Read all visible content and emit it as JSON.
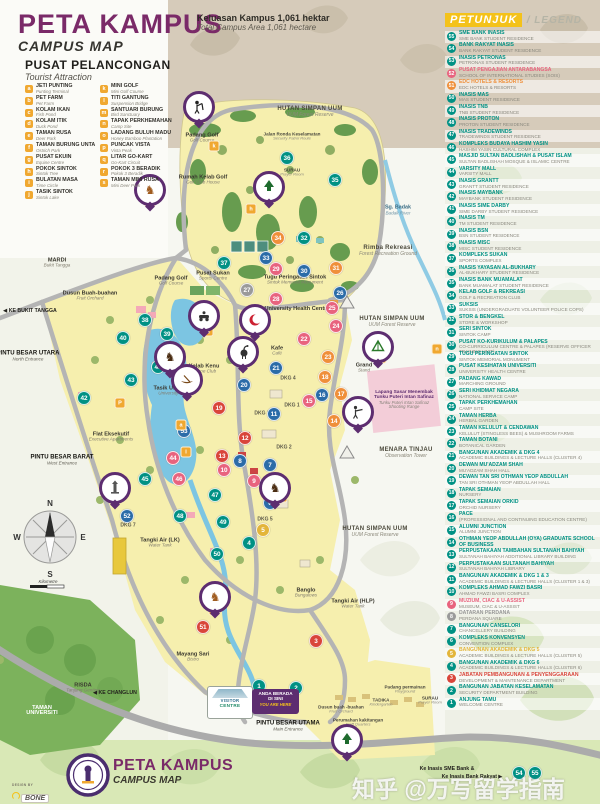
{
  "header": {
    "title": "PETA KAMPUS",
    "subtitle": "CAMPUS MAP",
    "area_my": "Keluasan Kampus 1,061 hektar",
    "area_en": "Total Campus Area 1,061 hectare"
  },
  "tourist": {
    "title": "PUSAT PELANCONGAN",
    "subtitle": "Tourist Attraction",
    "items": [
      {
        "letter": "a",
        "name": "JETI PUNTING",
        "en": "Punting Terminal"
      },
      {
        "letter": "b",
        "name": "PET FARM",
        "en": "Pet Farm"
      },
      {
        "letter": "c",
        "name": "KOLAM IKAN",
        "en": "Fish Pond"
      },
      {
        "letter": "d",
        "name": "KOLAM ITIK",
        "en": "Duck Pond"
      },
      {
        "letter": "e",
        "name": "TAMAN RUSA",
        "en": "Deer Park"
      },
      {
        "letter": "f",
        "name": "TAMAN BURUNG UNTA",
        "en": "Ostrich Park"
      },
      {
        "letter": "g",
        "name": "PUSAT EKUIN",
        "en": "Equine Centre"
      },
      {
        "letter": "h",
        "name": "POKOK SINTOK",
        "en": "Sintok Tree"
      },
      {
        "letter": "i",
        "name": "BULATAN MASA",
        "en": "Time Circle"
      },
      {
        "letter": "j",
        "name": "TASIK SINTOK",
        "en": "Sintok Lake"
      },
      {
        "letter": "k",
        "name": "MINI GOLF",
        "en": "Mini Golf Course"
      },
      {
        "letter": "l",
        "name": "TITI GANTUNG",
        "en": "Suspension Bridge"
      },
      {
        "letter": "m",
        "name": "SANTUARI BURUNG",
        "en": "Bird Sanctuary"
      },
      {
        "letter": "n",
        "name": "TAPAK PERKHEMAHAN",
        "en": "Camp Site"
      },
      {
        "letter": "o",
        "name": "LADANG BULUH MADU",
        "en": "Honey Bamboo Plantation"
      },
      {
        "letter": "p",
        "name": "PUNCAK VISTA",
        "en": "Vista Peak"
      },
      {
        "letter": "q",
        "name": "LITAR GO-KART",
        "en": "Go-Kart Circuit"
      },
      {
        "letter": "r",
        "name": "POKOK 3 BERADIK",
        "en": "Pokok 3 Beradik"
      },
      {
        "letter": "s",
        "name": "TAMAN MINI RUSA",
        "en": "Mini Deer Park"
      }
    ]
  },
  "legend": {
    "title": "PETUNJUK",
    "title_en": "/  LEGEND",
    "items": [
      {
        "n": 55,
        "my": "SME BANK INASIS",
        "en": "SME BANK STUDENT RESIDENCE"
      },
      {
        "n": 54,
        "my": "BANK RAKYAT INASIS",
        "en": "BANK RAKYAT STUDENT RESIDENCE"
      },
      {
        "n": 53,
        "my": "INASIS PETRONAS",
        "en": "PETRONAS STUDENT RESIDENCE"
      },
      {
        "n": 52,
        "my": "PUSAT PENGAJIAN ANTARABANGSA",
        "en": "SCHOOL OF INTERNATIONAL STUDIES (SOIS)",
        "c": "#e8637e"
      },
      {
        "n": 51,
        "my": "EDC HOTELS & RESORTS",
        "en": "EDC HOTELS & RESORTS",
        "c": "#ef8f3a"
      },
      {
        "n": 50,
        "my": "INASIS MAS",
        "en": "MAS STUDENT RESIDENCE"
      },
      {
        "n": 49,
        "my": "INASIS TNB",
        "en": "TNB STUDENT RESIDENCE"
      },
      {
        "n": 48,
        "my": "INASIS PROTON",
        "en": "PROTON STUDENT RESIDENCE"
      },
      {
        "n": 47,
        "my": "INASIS TRADEWINDS",
        "en": "TRADEWINDS STUDENT RESIDENCE"
      },
      {
        "n": 46,
        "my": "KOMPLEKS BUDAYA HASHIM YASIN",
        "en": "HASHIM YASIN CULTURAL COMPLEX"
      },
      {
        "n": 45,
        "my": "MASJID SULTAN BADLISHAH & PUSAT ISLAM",
        "en": "SULTAN BADLISHAH MOSQUE & ISLAMIC CENTRE"
      },
      {
        "n": 44,
        "my": "VARSITY MALL",
        "en": "VARSITY MALL"
      },
      {
        "n": 43,
        "my": "INASIS GRANTT",
        "en": "GRANTT STUDENT RESIDENCE"
      },
      {
        "n": 42,
        "my": "INASIS MAYBANK",
        "en": "MAYBANK STUDENT RESIDENCE"
      },
      {
        "n": 41,
        "my": "INASIS SIME DARBY",
        "en": "SIME DARBY STUDENT RESIDENCE"
      },
      {
        "n": 40,
        "my": "INASIS TM",
        "en": "TM STUDENT RESIDENCE"
      },
      {
        "n": 39,
        "my": "INASIS BSN",
        "en": "BSN STUDENT RESIDENCE"
      },
      {
        "n": 38,
        "my": "INASIS MISC",
        "en": "MISC STUDENT RESIDENCE"
      },
      {
        "n": 37,
        "my": "KOMPLEKS SUKAN",
        "en": "SPORTS COMPLEX"
      },
      {
        "n": 36,
        "my": "INASIS YAYASAN AL-BUKHARY",
        "en": "AL-BUKHARY STUDENT RESIDENCE"
      },
      {
        "n": 35,
        "my": "INASIS BANK MUAMALAT",
        "en": "BANK MUAMALAT STUDENT RESIDENCE"
      },
      {
        "n": 34,
        "my": "KELAB GOLF & REKREASI",
        "en": "GOLF & RECREATION CLUB"
      },
      {
        "n": 33,
        "my": "SUKSIS",
        "en": "SUKSIS (UNDERGRADUATE VOLUNTEER POLICE COPS)"
      },
      {
        "n": 32,
        "my": "STOR & BENGKEL",
        "en": "STORE & WORKSHOP"
      },
      {
        "n": 31,
        "my": "SERI SINTOK",
        "en": "SINTOK CAMP"
      },
      {
        "n": 30,
        "my": "PUSAT KO-KURIKULUM & PALAPES",
        "en": "CO-CURRICULUM CENTRE & PALAPES (RESERVE OFFICER TRAINING UNIT)"
      },
      {
        "n": 29,
        "my": "TUGU PERINGATAN SINTOK",
        "en": "SINTOK MEMORIAL MONUMENT"
      },
      {
        "n": 28,
        "my": "PUSAT KESIHATAN UNIVERSITI",
        "en": "UNIVERSITY HEALTH CENTRE"
      },
      {
        "n": 27,
        "my": "PADANG KAWAD",
        "en": "MARCHING GROUND"
      },
      {
        "n": 26,
        "my": "SERI KHIDMAT NEGARA",
        "en": "NATIONAL SERVICE CAMP"
      },
      {
        "n": 25,
        "my": "TAPAK PERKHEMAHAN",
        "en": "CAMP SITE"
      },
      {
        "n": 24,
        "my": "TAMAN HERBA",
        "en": "HERBAL GARDEN"
      },
      {
        "n": 23,
        "my": "TAMAN KELULUT & CENDAWAN",
        "en": "KELULUT (STINGLESS BEES) & MUSHROOM FARMS"
      },
      {
        "n": 22,
        "my": "TAMAN BOTANI",
        "en": "BOTANICAL GARDEN"
      },
      {
        "n": 21,
        "my": "BANGUNAN AKADEMIK & DKG 4",
        "en": "ACADEMIC BUILDINGS & LECTURE HALLS (CLUSTER 4)"
      },
      {
        "n": 20,
        "my": "DEWAN MU'ADZAM SHAH",
        "en": "MU'ADZAM SHAH HALL"
      },
      {
        "n": 19,
        "my": "DEWAN TAN SRI OTHMAN YEOP ABDULLAH",
        "en": "TAN SRI OTHMAN YEOP ABDULLAH HALL"
      },
      {
        "n": 18,
        "my": "TAPAK SEMAIAN",
        "en": "NURSERY"
      },
      {
        "n": 17,
        "my": "TAPAK SEMAIAN ORKID",
        "en": "ORCHID NURSERY"
      },
      {
        "n": 16,
        "my": "PACE",
        "en": "(PROFESSIONAL AND CONTINUING EDUCATION CENTRE)"
      },
      {
        "n": 15,
        "my": "ALUMNI JUNCTION",
        "en": "ALUMNI JUNCTION"
      },
      {
        "n": 14,
        "my": "OTHMAN YEOP ABDULLAH (OYA) GRADUATE SCHOOL OF BUSINESS",
        "en": ""
      },
      {
        "n": 13,
        "my": "PERPUSTAKAAN TAMBAHAN SULTANAH BAHIYAH",
        "en": "SULTANAH BAHIYAH ADDITIONAL LIBRARY BUILDING"
      },
      {
        "n": 12,
        "my": "PERPUSTAKAAN SULTANAH BAHIYAH",
        "en": "SULTANAH BAHIYAH LIBRARY"
      },
      {
        "n": 11,
        "my": "BANGUNAN AKADEMIK & DKG 1 & 3",
        "en": "ACADEMIC BUILDINGS & LECTURE HALLS (CLUSTER 1 & 3)"
      },
      {
        "n": 10,
        "my": "KOMPLEKS AHMAD FAWZI BASRI",
        "en": "AHMAD FAWZI BASRI COMPLEX"
      },
      {
        "n": 9,
        "my": "MUZIUM, CIAC & U-ASSIST",
        "en": "MUSEUM, CIAC & U-ASSIST",
        "c": "#e8637e"
      },
      {
        "n": 8,
        "my": "DATARAN PERDANA",
        "en": "PERDANA SQUARE",
        "c": "#9a9a9a"
      },
      {
        "n": 7,
        "my": "BANGUNAN CANSELORI",
        "en": "CHANCELLERY BUILDING"
      },
      {
        "n": 6,
        "my": "KOMPLEKS KONVENSYEN",
        "en": "CONVENTION COMPLEX"
      },
      {
        "n": 5,
        "my": "BANGUNAN AKADEMIK & DKG 5",
        "en": "ACADEMIC BUILDINGS & LECTURE HALLS (CLUSTER 5)",
        "c": "#e3b53a"
      },
      {
        "n": 4,
        "my": "BANGUNAN AKADEMIK & DKG 6",
        "en": "ACADEMIC BUILDINGS & LECTURE HALLS (CLUSTER 6)"
      },
      {
        "n": 3,
        "my": "JABATAN PEMBANGUNAN & PENYENGGARAAN",
        "en": "DEVELOPMENT & MAINTENANCE DEPARTMENT",
        "c": "#d9453a"
      },
      {
        "n": 2,
        "my": "BANGUNAN JABATAN KESELAMATAN",
        "en": "SECURITY DEPARTMENT BUILDING"
      },
      {
        "n": 1,
        "my": "ANJUNG TAMU",
        "en": "WELCOME CENTRE"
      }
    ]
  },
  "map": {
    "badges": [
      [
        36,
        287,
        158,
        "t"
      ],
      [
        35,
        335,
        180,
        "t"
      ],
      [
        34,
        278,
        238,
        "o"
      ],
      [
        32,
        304,
        238,
        "t"
      ],
      [
        33,
        266,
        258,
        "b"
      ],
      [
        37,
        224,
        263,
        "t"
      ],
      [
        29,
        276,
        269,
        "p"
      ],
      [
        30,
        304,
        271,
        "b"
      ],
      [
        31,
        336,
        268,
        "o"
      ],
      [
        26,
        340,
        293,
        "b"
      ],
      [
        28,
        276,
        299,
        "p"
      ],
      [
        27,
        247,
        290,
        "g"
      ],
      [
        25,
        332,
        308,
        "p"
      ],
      [
        24,
        336,
        326,
        "p"
      ],
      [
        22,
        304,
        339,
        "p"
      ],
      [
        23,
        328,
        357,
        "o"
      ],
      [
        21,
        276,
        368,
        "b"
      ],
      [
        18,
        325,
        377,
        "o"
      ],
      [
        20,
        244,
        385,
        "b"
      ],
      [
        16,
        322,
        395,
        "b"
      ],
      [
        17,
        341,
        394,
        "o"
      ],
      [
        15,
        309,
        401,
        "p"
      ],
      [
        19,
        219,
        408,
        "r"
      ],
      [
        11,
        274,
        414,
        "b"
      ],
      [
        14,
        334,
        421,
        "o"
      ],
      [
        12,
        245,
        438,
        "r"
      ],
      [
        13,
        222,
        456,
        "r"
      ],
      [
        10,
        224,
        470,
        "p"
      ],
      [
        8,
        240,
        461,
        "b"
      ],
      [
        7,
        270,
        465,
        "b"
      ],
      [
        9,
        254,
        481,
        "p"
      ],
      [
        6,
        270,
        503,
        "b"
      ],
      [
        5,
        263,
        530,
        "y"
      ],
      [
        4,
        249,
        543,
        "t"
      ],
      [
        38,
        145,
        320,
        "t"
      ],
      [
        39,
        167,
        334,
        "t"
      ],
      [
        40,
        123,
        338,
        "t"
      ],
      [
        41,
        158,
        367,
        "t"
      ],
      [
        43,
        131,
        380,
        "t"
      ],
      [
        42,
        84,
        398,
        "t"
      ],
      [
        53,
        184,
        431,
        "b"
      ],
      [
        44,
        173,
        458,
        "p"
      ],
      [
        45,
        145,
        479,
        "t"
      ],
      [
        46,
        179,
        479,
        "p"
      ],
      [
        47,
        215,
        495,
        "t"
      ],
      [
        48,
        180,
        516,
        "t"
      ],
      [
        49,
        223,
        522,
        "t"
      ],
      [
        52,
        127,
        516,
        "b"
      ],
      [
        50,
        217,
        554,
        "t"
      ],
      [
        51,
        203,
        627,
        "r"
      ],
      [
        3,
        316,
        641,
        "r"
      ],
      [
        2,
        296,
        688,
        "t"
      ],
      [
        1,
        259,
        686,
        "t"
      ],
      [
        54,
        519,
        773,
        "t"
      ],
      [
        55,
        535,
        773,
        "t"
      ]
    ],
    "letter_badges": [
      [
        "h",
        251,
        209
      ],
      [
        "k",
        214,
        146
      ],
      [
        "q",
        208,
        331
      ],
      [
        "e",
        150,
        202
      ],
      [
        "g",
        282,
        497
      ],
      [
        "s",
        214,
        610
      ],
      [
        "m",
        381,
        358
      ],
      [
        "n",
        437,
        349
      ],
      [
        "a",
        181,
        425
      ],
      [
        "l",
        186,
        452
      ],
      [
        "P",
        120,
        403
      ]
    ],
    "pins": [
      [
        "golfer",
        199,
        107
      ],
      [
        "deer",
        150,
        190
      ],
      [
        "tree",
        269,
        187
      ],
      [
        "kart",
        204,
        316
      ],
      [
        "crescent",
        255,
        320
      ],
      [
        "horse",
        170,
        357
      ],
      [
        "bird",
        243,
        352
      ],
      [
        "canoe",
        187,
        380
      ],
      [
        "picnic",
        378,
        347
      ],
      [
        "shooter",
        358,
        412
      ],
      [
        "tower",
        115,
        488
      ],
      [
        "horse",
        275,
        488
      ],
      [
        "deer",
        215,
        597
      ],
      [
        "tree",
        347,
        740
      ]
    ],
    "labels": [
      [
        202,
        138,
        "place",
        "Padang Golf",
        "Golf Course"
      ],
      [
        203,
        180,
        "place",
        "Rumah Kelab Golf",
        "Golf Club House"
      ],
      [
        292,
        136,
        "tiny",
        "Jalan Ronda Keselamatan",
        "Security Patrol Route"
      ],
      [
        292,
        172,
        "tiny",
        "SURAU",
        "Prayer Room"
      ],
      [
        398,
        211,
        "water",
        "Sg. Badak",
        "Badak River"
      ],
      [
        388,
        251,
        "forest",
        "Rimba Rekreasi",
        "Forest Recreation Ground"
      ],
      [
        310,
        112,
        "forest",
        "HUTAN SIMPAN UUM",
        "UUM Forest Reserve"
      ],
      [
        392,
        322,
        "forest",
        "HUTAN SIMPAN UUM",
        "UUM Forest Reserve"
      ],
      [
        375,
        532,
        "forest",
        "HUTAN SIMPAN UUM",
        "UUM Forest Reserve"
      ],
      [
        57,
        263,
        "place",
        "MARDI",
        "Bukit Tangga"
      ],
      [
        90,
        296,
        "place",
        "Dusun Buah-buahan",
        "Fruit Orchard"
      ],
      [
        30,
        312,
        "road",
        "◀ KE BUKIT TANGGA",
        ""
      ],
      [
        28,
        356,
        "entrance",
        "PINTU BESAR UTARA",
        "North Entrance"
      ],
      [
        171,
        281,
        "place",
        "Padang Golf",
        "Golf Course"
      ],
      [
        213,
        276,
        "place",
        "Pusat Sukan",
        "Sports Centre"
      ],
      [
        295,
        280,
        "place",
        "Tugu Peringatan Sintok",
        "Sintok Memorial Monument"
      ],
      [
        297,
        309,
        "place",
        "University Health Centre",
        ""
      ],
      [
        277,
        351,
        "place",
        "Kafe",
        "Café"
      ],
      [
        204,
        369,
        "place",
        "Kelab Kenu",
        "Canoe Club"
      ],
      [
        174,
        391,
        "place",
        "Tasik Universiti",
        "University Lake"
      ],
      [
        364,
        368,
        "place",
        "Grand",
        "Stand"
      ],
      [
        404,
        400,
        "purple",
        "Lapang Sasar Menembak Tunku Puteri Intan Safinaz",
        "Tunku Puteri Intan Safinaz Shooting Range"
      ],
      [
        406,
        453,
        "forest",
        "MENARA TINJAU",
        "Observation Tower"
      ],
      [
        111,
        437,
        "place",
        "Flat Eksekutif",
        "Executive Apartments"
      ],
      [
        62,
        460,
        "entrance",
        "PINTU BESAR BARAT",
        "West Entrance"
      ],
      [
        288,
        379,
        "dkg",
        "DKG 4",
        ""
      ],
      [
        292,
        406,
        "dkg",
        "DKG 1",
        ""
      ],
      [
        262,
        414,
        "dkg",
        "DKG 3",
        ""
      ],
      [
        284,
        448,
        "dkg",
        "DKG 2",
        ""
      ],
      [
        265,
        520,
        "dkg",
        "DKG 5",
        ""
      ],
      [
        128,
        526,
        "dkg",
        "DKG 7",
        ""
      ],
      [
        160,
        543,
        "place",
        "Tangki Air (LK)",
        "Water Tank"
      ],
      [
        353,
        604,
        "place",
        "Tangki Air (HLP)",
        "Water Tank"
      ],
      [
        306,
        593,
        "place",
        "Banglo",
        "Bungalows"
      ],
      [
        193,
        657,
        "place",
        "Mayang Sari",
        "Bistro"
      ],
      [
        83,
        688,
        "place",
        "RISDA",
        "Tanjung Genting"
      ],
      [
        42,
        711,
        "white",
        "TAMAN",
        "UNIVERSITI"
      ],
      [
        115,
        694,
        "road",
        "◀ KE CHANGLUN",
        ""
      ],
      [
        341,
        709,
        "tiny",
        "Dusun buah -buahan",
        "Fruit Orchard"
      ],
      [
        358,
        722,
        "tiny",
        "Perumahan kakitangan",
        "Staff Quarters"
      ],
      [
        381,
        702,
        "tiny",
        "TADIKA",
        "Kindergarten"
      ],
      [
        430,
        700,
        "tiny",
        "SURAU",
        "Prayer Room"
      ],
      [
        405,
        689,
        "tiny",
        "Padang permainan",
        "Playground"
      ],
      [
        288,
        726,
        "entrance",
        "PINTU BESAR UTAMA",
        "Main Entrance"
      ],
      [
        447,
        770,
        "road",
        "Ke Inasis SME Bank &",
        ""
      ],
      [
        472,
        778,
        "road",
        "Ke Inasis Bank Rakyat ▶",
        ""
      ]
    ],
    "you_are_here": {
      "line1": "ANDA BERADA",
      "line2": "DI SINI",
      "line3": "YOU ARE HERE"
    },
    "visitor_sign": {
      "line1": "VISITOR",
      "line2": "CENTRE"
    },
    "compass": {
      "n": "N",
      "s": "S",
      "e": "E",
      "w": "W",
      "scale": "Kilometre"
    }
  },
  "footer": {
    "title": "PETA KAMPUS",
    "subtitle": "CAMPUS MAP",
    "design_by": "DESIGN BY",
    "brand": "BONE"
  },
  "watermark": "知乎 @万写留学指南",
  "colors": {
    "t": "#009184",
    "b": "#2b6ca8",
    "p": "#e8637e",
    "o": "#ef8f3a",
    "r": "#d9453a",
    "y": "#e3b53a",
    "g": "#9a9a9a",
    "accent_purple": "#7a2a68",
    "pin_purple": "#5d2d70",
    "badge_orange": "#f0a830",
    "legend_teal": "#009184"
  }
}
